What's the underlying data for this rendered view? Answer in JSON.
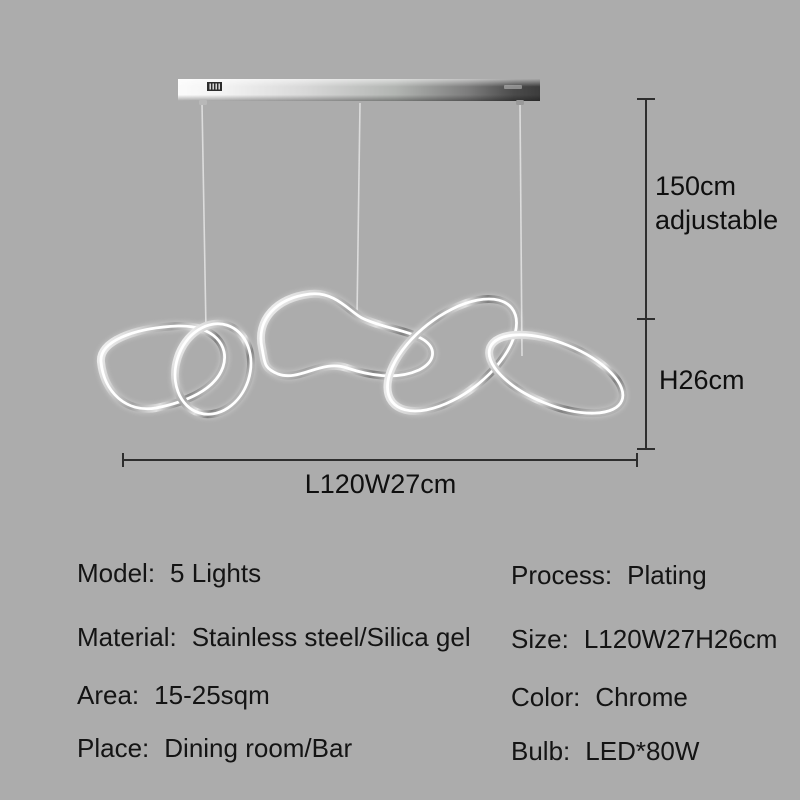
{
  "colors": {
    "background": "#acacac",
    "text": "#141414",
    "dimension_line": "#2e2e2e",
    "chrome_light": "#f8f8f8",
    "chrome_dark": "#3c3c3c",
    "led_glow": "#ffffff"
  },
  "fixture": {
    "type": "pendant-chandelier",
    "ring_count": 5
  },
  "dimensions": {
    "drop_line1": "150cm",
    "drop_line2": "adjustable",
    "height": "H26cm",
    "width": "L120W27cm"
  },
  "specs": {
    "left": [
      {
        "label": "Model:",
        "value": "5 Lights"
      },
      {
        "label": "Material:",
        "value": "Stainless steel/Silica gel"
      },
      {
        "label": "Area:",
        "value": "15-25sqm"
      },
      {
        "label": "Place:",
        "value": "Dining room/Bar"
      }
    ],
    "right": [
      {
        "label": "Process:",
        "value": "Plating"
      },
      {
        "label": "Size:",
        "value": "L120W27H26cm"
      },
      {
        "label": "Color:",
        "value": "Chrome"
      },
      {
        "label": "Bulb:",
        "value": "LED*80W"
      }
    ]
  }
}
